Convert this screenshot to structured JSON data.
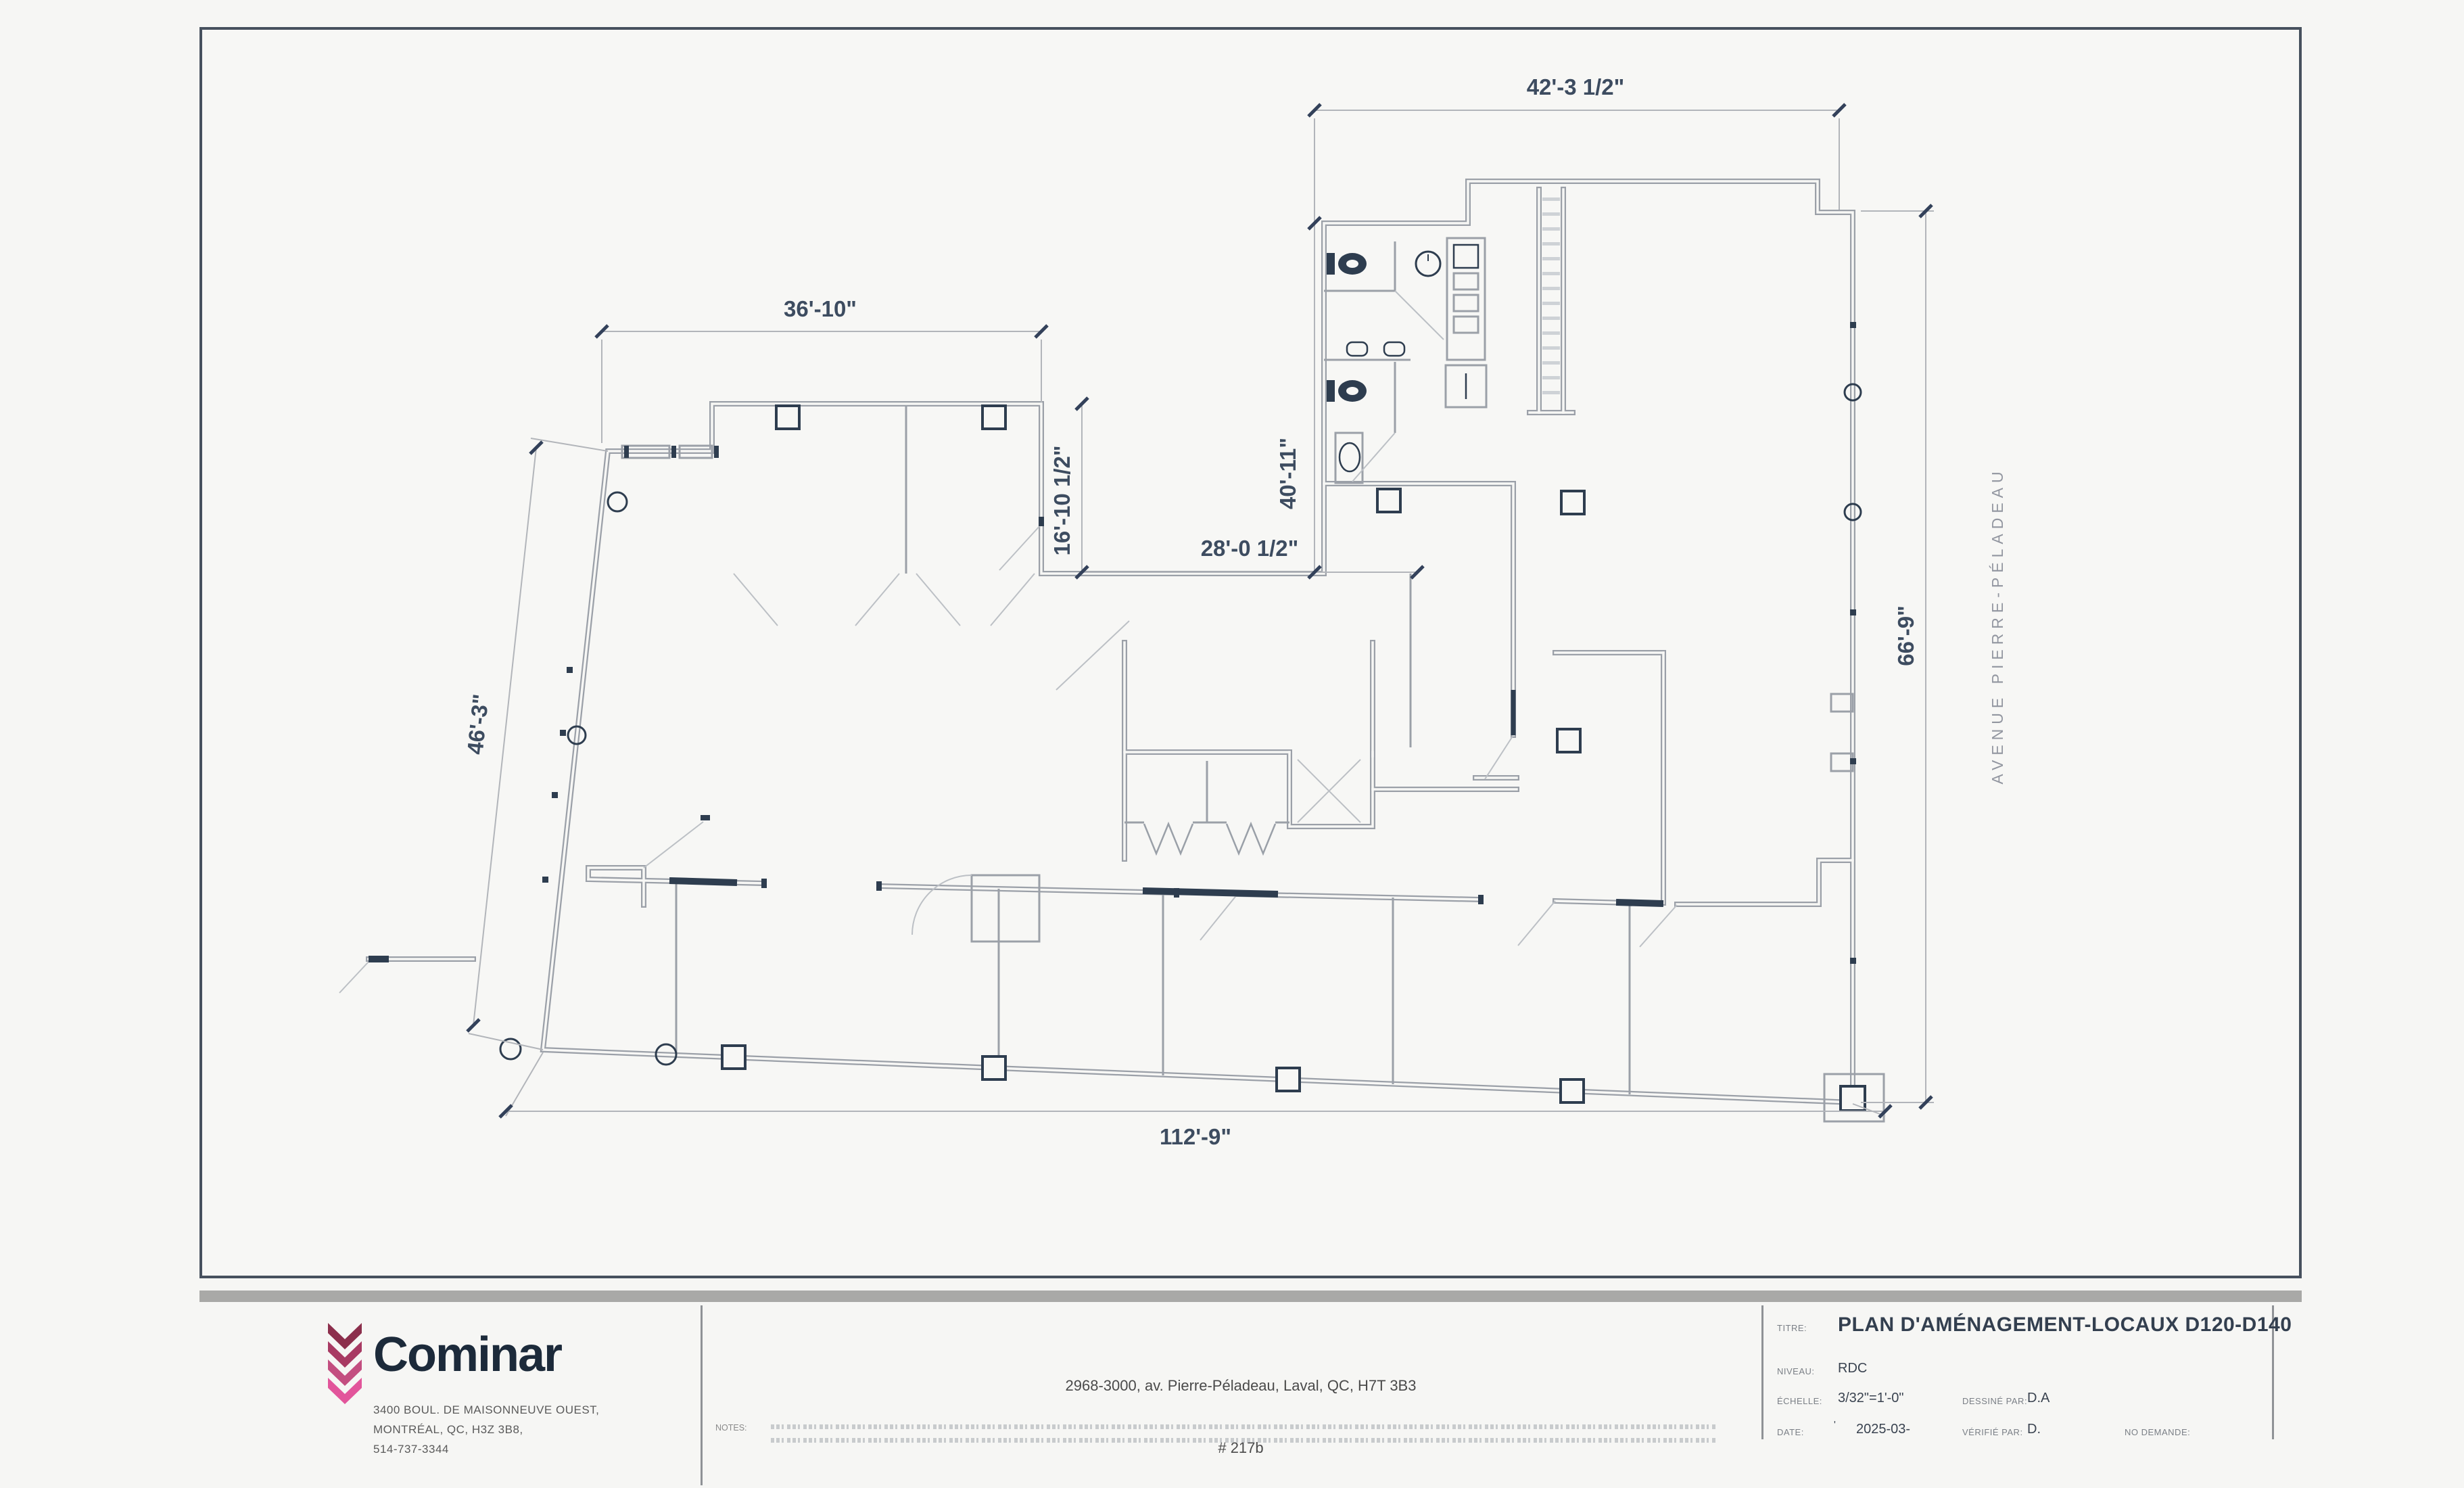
{
  "plan": {
    "street_label": "AVENUE PIERRE-PÉLADEAU",
    "dimensions": {
      "top": "42'-3 1/2\"",
      "upper_left": "36'-10\"",
      "vertical_40": "40'-11\"",
      "vertical_16": "16'-10 1/2\"",
      "horizontal_28": "28'-0 1/2\"",
      "right_66": "66'-9\"",
      "slant_46": "46'-3\"",
      "bottom_112": "112'-9\""
    }
  },
  "title_block": {
    "company": {
      "name": "Cominar",
      "address_line1": "3400 BOUL. DE MAISONNEUVE OUEST,",
      "address_line2": "MONTRÉAL, QC, H3Z 3B8,",
      "phone": "514-737-3344"
    },
    "project": {
      "address": "2968-3000, av. Pierre-Péladeau, Laval, QC, H7T 3B3",
      "unit": "# 217b"
    },
    "notes_label": "NOTES:",
    "fields": {
      "titre_label": "TITRE:",
      "titre_value": "PLAN D'AMÉNAGEMENT-LOCAUX D120-D140",
      "niveau_label": "NIVEAU:",
      "niveau_value": "RDC",
      "echelle_label": "ÉCHELLE:",
      "echelle_value": "3/32\"=1'-0\"",
      "date_label": "DATE:",
      "date_prefix": "'",
      "date_value": "2025-03-",
      "dessine_label": "DESSINÉ PAR:",
      "dessine_value": "D.A",
      "verifie_label": "VÉRIFIÉ PAR:",
      "verifie_value": "D.",
      "demande_label": "NO DEMANDE:",
      "demande_value": ""
    }
  },
  "colors": {
    "logo_chevron_1": "#8c2f4c",
    "logo_chevron_2": "#a83a63",
    "logo_chevron_3": "#c34e80",
    "logo_chevron_4": "#e2559b",
    "wordmark_navy": "#1c2a3a",
    "wall_gray": "#9ba0a8",
    "accent_navy": "#2e3d4f"
  }
}
